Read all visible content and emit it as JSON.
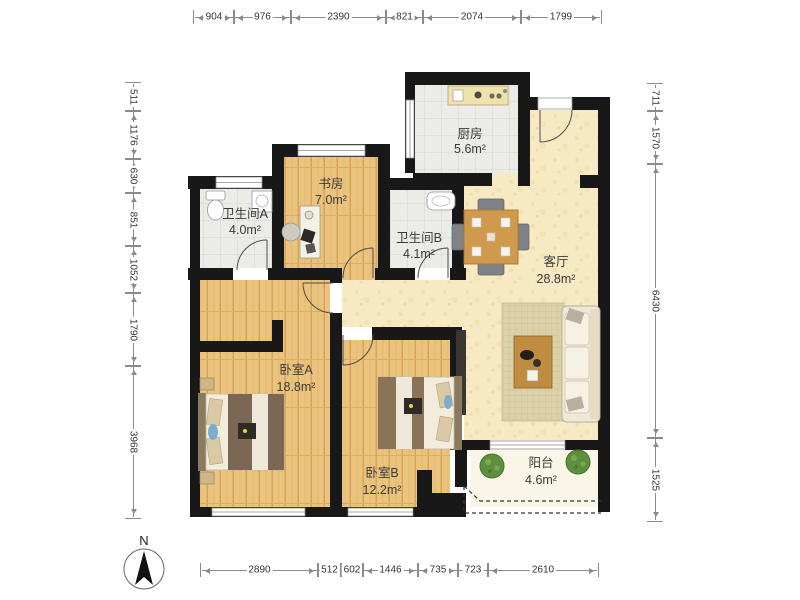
{
  "plan_title": "apartment-floor-plan",
  "rooms": {
    "kitchen": {
      "name": "厨房",
      "area": "5.6m²"
    },
    "bath_a": {
      "name": "卫生间A",
      "area": "4.0m²"
    },
    "study": {
      "name": "书房",
      "area": "7.0m²"
    },
    "bath_b": {
      "name": "卫生间B",
      "area": "4.1m²"
    },
    "living": {
      "name": "客厅",
      "area": "28.8m²"
    },
    "bed_a": {
      "name": "卧室A",
      "area": "18.8m²"
    },
    "bed_b": {
      "name": "卧室B",
      "area": "12.2m²"
    },
    "balcony": {
      "name": "阳台",
      "area": "4.6m²"
    }
  },
  "dimensions": {
    "top": [
      {
        "value": "904"
      },
      {
        "value": "976"
      },
      {
        "value": "2390"
      },
      {
        "value": "821"
      },
      {
        "value": "2074"
      },
      {
        "value": "1799"
      }
    ],
    "left": [
      {
        "value": "511"
      },
      {
        "value": "1176"
      },
      {
        "value": "630"
      },
      {
        "value": "851"
      },
      {
        "value": "1052"
      },
      {
        "value": "1790"
      },
      {
        "value": "3968"
      }
    ],
    "right": [
      {
        "value": "711"
      },
      {
        "value": "1570"
      },
      {
        "value": "6430"
      },
      {
        "value": "1525"
      }
    ],
    "bottom": [
      {
        "value": "2890"
      },
      {
        "value": "512"
      },
      {
        "value": "602"
      },
      {
        "value": "1446"
      },
      {
        "value": "735"
      },
      {
        "value": "723"
      },
      {
        "value": "2610"
      }
    ]
  },
  "compass": {
    "label": "N"
  },
  "colors": {
    "wall": "#181818",
    "wood_floor": "#eac47e",
    "tile_floor": "#ebebe7",
    "living_floor": "#f7e9c2",
    "balcony_floor": "#f9f5e7",
    "dim_text": "#333333",
    "label_text": "#3a3a3a"
  }
}
